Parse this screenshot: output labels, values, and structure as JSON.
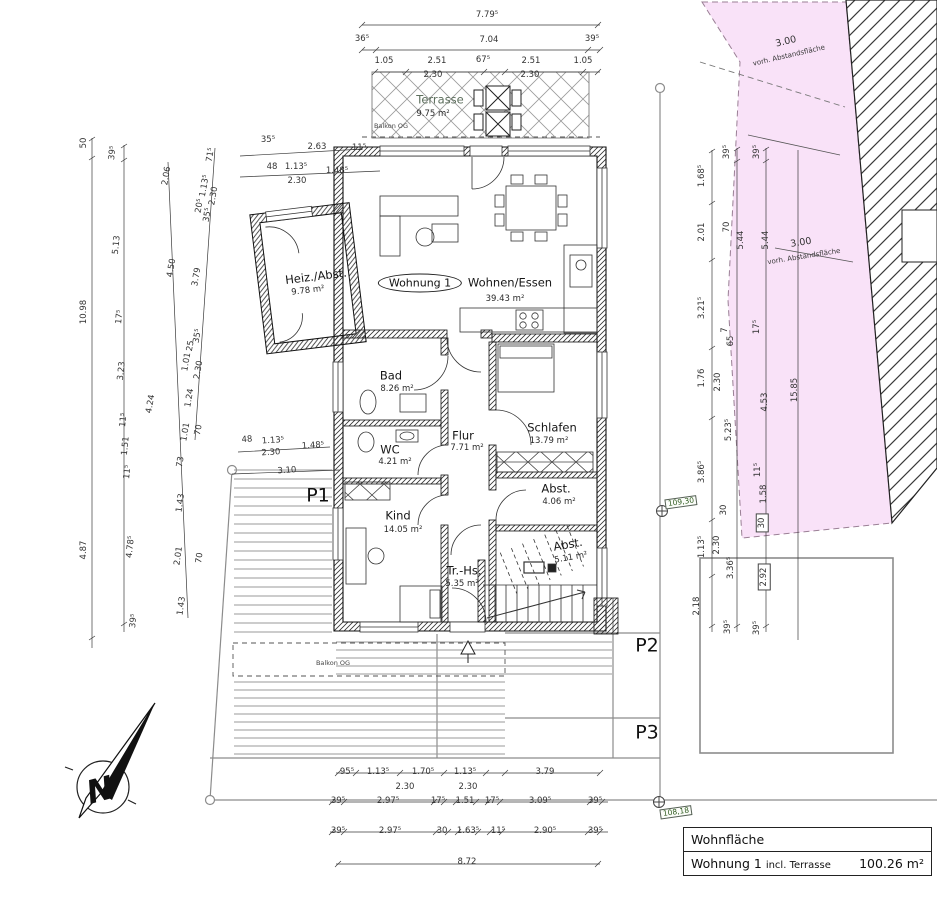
{
  "unit_tag": {
    "label": "Wohnung 1"
  },
  "north": {
    "label": "N"
  },
  "area_table": {
    "header": "Wohnfläche",
    "row": {
      "name": "Wohnung 1",
      "suffix": "incl. Terrasse",
      "value": "100.26 m²"
    }
  },
  "rooms": [
    {
      "name": "Terrasse",
      "area": "9.75 m²",
      "x": 440,
      "y": 100,
      "ax": 433,
      "ay": 114,
      "r": 0,
      "muted": true
    },
    {
      "name": "Wohnen/Essen",
      "area": "39.43 m²",
      "x": 510,
      "y": 283,
      "ax": 505,
      "ay": 299,
      "r": 0
    },
    {
      "name": "Heiz./Abst.",
      "area": "9.78 m²",
      "x": 316,
      "y": 277,
      "ax": 308,
      "ay": 291,
      "r": -7
    },
    {
      "name": "Bad",
      "area": "8.26 m²",
      "x": 391,
      "y": 376,
      "ax": 397,
      "ay": 389,
      "r": 0
    },
    {
      "name": "WC",
      "area": "4.21 m²",
      "x": 390,
      "y": 450,
      "ax": 395,
      "ay": 462,
      "r": 0
    },
    {
      "name": "Flur",
      "area": "7.71 m²",
      "x": 463,
      "y": 436,
      "ax": 467,
      "ay": 448,
      "r": 0
    },
    {
      "name": "Schlafen",
      "area": "13.79 m²",
      "x": 552,
      "y": 428,
      "ax": 549,
      "ay": 441,
      "r": 0
    },
    {
      "name": "Abst.",
      "area": "4.06 m²",
      "x": 556,
      "y": 489,
      "ax": 559,
      "ay": 502,
      "r": 0
    },
    {
      "name": "Kind",
      "area": "14.05 m²",
      "x": 398,
      "y": 516,
      "ax": 403,
      "ay": 530,
      "r": 0
    },
    {
      "name": "Tr.-Hs.",
      "area": "5.35 m²",
      "x": 464,
      "y": 571,
      "ax": 462,
      "ay": 584,
      "r": 0
    },
    {
      "name": "Abst.",
      "area": "5.11 m²",
      "x": 568,
      "y": 545,
      "ax": 571,
      "ay": 558,
      "r": -10
    }
  ],
  "parking_labels": [
    {
      "t": "P1",
      "x": 318,
      "y": 496
    },
    {
      "t": "P2",
      "x": 647,
      "y": 646
    },
    {
      "t": "P3",
      "x": 647,
      "y": 733
    }
  ],
  "balkon_labels": [
    {
      "t": "Balkon OG",
      "x": 391,
      "y": 126
    },
    {
      "t": "Balkon OG",
      "x": 333,
      "y": 663
    }
  ],
  "abstand_labels": [
    {
      "dim": "3.00",
      "text": "vorh. Abstandsfläche",
      "x": 786,
      "y": 42,
      "r": -13
    },
    {
      "dim": "3.00",
      "text": "vorh. Abstandsfläche",
      "x": 801,
      "y": 243,
      "r": -9
    }
  ],
  "survey_markers": [
    {
      "value": "109,30",
      "x": 681,
      "y": 502,
      "r": -8
    },
    {
      "value": "108,18",
      "x": 676,
      "y": 812,
      "r": -8
    }
  ],
  "dimension_labels": [
    {
      "t": "7.79⁵",
      "x": 487,
      "y": 15,
      "r": 0
    },
    {
      "t": "36⁵",
      "x": 362,
      "y": 39,
      "r": 0
    },
    {
      "t": "7.04",
      "x": 489,
      "y": 40,
      "r": 0
    },
    {
      "t": "39⁵",
      "x": 592,
      "y": 39,
      "r": 0
    },
    {
      "t": "1.05",
      "x": 384,
      "y": 61,
      "r": 0
    },
    {
      "t": "2.51",
      "x": 437,
      "y": 61,
      "r": 0
    },
    {
      "t": "67⁵",
      "x": 483,
      "y": 60,
      "r": 0
    },
    {
      "t": "2.51",
      "x": 531,
      "y": 61,
      "r": 0
    },
    {
      "t": "1.05",
      "x": 583,
      "y": 61,
      "r": 0
    },
    {
      "t": "2.30",
      "x": 433,
      "y": 75,
      "r": 0
    },
    {
      "t": "2.30",
      "x": 530,
      "y": 75,
      "r": 0
    },
    {
      "t": "35⁵",
      "x": 268,
      "y": 140,
      "r": 0
    },
    {
      "t": "2.63",
      "x": 317,
      "y": 147,
      "r": 0
    },
    {
      "t": "11⁵",
      "x": 359,
      "y": 148,
      "r": 0
    },
    {
      "t": "48",
      "x": 272,
      "y": 167,
      "r": 0
    },
    {
      "t": "1.13⁵",
      "x": 296,
      "y": 167,
      "r": 0
    },
    {
      "t": "1.48⁵",
      "x": 337,
      "y": 171,
      "r": 0
    },
    {
      "t": "2.30",
      "x": 297,
      "y": 181,
      "r": 0
    },
    {
      "t": "48",
      "x": 247,
      "y": 440,
      "r": -4
    },
    {
      "t": "1.13⁵",
      "x": 273,
      "y": 441,
      "r": -4
    },
    {
      "t": "1.48⁵",
      "x": 313,
      "y": 446,
      "r": -4
    },
    {
      "t": "2.30",
      "x": 271,
      "y": 453,
      "r": -4
    },
    {
      "t": "3.10",
      "x": 287,
      "y": 471,
      "r": -4
    },
    {
      "t": "50",
      "x": 84,
      "y": 143,
      "r": -90
    },
    {
      "t": "10.98",
      "x": 84,
      "y": 312,
      "r": -90
    },
    {
      "t": "4.87",
      "x": 84,
      "y": 550,
      "r": -90
    },
    {
      "t": "39⁵",
      "x": 113,
      "y": 153,
      "r": -84
    },
    {
      "t": "5.13",
      "x": 117,
      "y": 245,
      "r": -84
    },
    {
      "t": "17⁵",
      "x": 120,
      "y": 317,
      "r": -84
    },
    {
      "t": "3.23",
      "x": 122,
      "y": 371,
      "r": -84
    },
    {
      "t": "11⁵",
      "x": 124,
      "y": 420,
      "r": -84
    },
    {
      "t": "1.51",
      "x": 126,
      "y": 446,
      "r": -84
    },
    {
      "t": "11⁵",
      "x": 128,
      "y": 472,
      "r": -84
    },
    {
      "t": "4.78⁵",
      "x": 131,
      "y": 547,
      "r": -84
    },
    {
      "t": "39⁵",
      "x": 134,
      "y": 621,
      "r": -84
    },
    {
      "t": "2.06",
      "x": 167,
      "y": 176,
      "r": -80
    },
    {
      "t": "4.50",
      "x": 172,
      "y": 268,
      "r": -80
    },
    {
      "t": "4.24",
      "x": 151,
      "y": 404,
      "r": -80
    },
    {
      "t": "73",
      "x": 181,
      "y": 462,
      "r": -80
    },
    {
      "t": "1.43",
      "x": 181,
      "y": 503,
      "r": -82
    },
    {
      "t": "2.01",
      "x": 179,
      "y": 556,
      "r": -82
    },
    {
      "t": "1.43",
      "x": 182,
      "y": 606,
      "r": -82
    },
    {
      "t": "71⁵",
      "x": 211,
      "y": 155,
      "r": -80
    },
    {
      "t": "1.13⁵",
      "x": 205,
      "y": 186,
      "r": -80
    },
    {
      "t": "2.30",
      "x": 214,
      "y": 196,
      "r": -80
    },
    {
      "t": "20⁵",
      "x": 200,
      "y": 206,
      "r": -80
    },
    {
      "t": "35⁵",
      "x": 208,
      "y": 215,
      "r": -80
    },
    {
      "t": "3.79",
      "x": 197,
      "y": 277,
      "r": -80
    },
    {
      "t": "35⁵",
      "x": 198,
      "y": 336,
      "r": -80
    },
    {
      "t": "25",
      "x": 191,
      "y": 346,
      "r": -80
    },
    {
      "t": "1.01",
      "x": 187,
      "y": 362,
      "r": -80
    },
    {
      "t": "2.30",
      "x": 199,
      "y": 370,
      "r": -80
    },
    {
      "t": "1.24",
      "x": 190,
      "y": 398,
      "r": -80
    },
    {
      "t": "1.01",
      "x": 186,
      "y": 432,
      "r": -80
    },
    {
      "t": "70",
      "x": 199,
      "y": 430,
      "r": -80
    },
    {
      "t": "70",
      "x": 200,
      "y": 558,
      "r": -82
    },
    {
      "t": "1.68⁵",
      "x": 702,
      "y": 176,
      "r": -90
    },
    {
      "t": "2.01",
      "x": 702,
      "y": 232,
      "r": -90
    },
    {
      "t": "3.21⁵",
      "x": 702,
      "y": 308,
      "r": -90
    },
    {
      "t": "1.76",
      "x": 702,
      "y": 378,
      "r": -90
    },
    {
      "t": "3.86⁵",
      "x": 702,
      "y": 472,
      "r": -90
    },
    {
      "t": "1.13⁵",
      "x": 702,
      "y": 547,
      "r": -90
    },
    {
      "t": "2.18",
      "x": 697,
      "y": 606,
      "r": -90
    },
    {
      "t": "39⁵",
      "x": 727,
      "y": 152,
      "r": -90
    },
    {
      "t": "70",
      "x": 727,
      "y": 227,
      "r": -90
    },
    {
      "t": "7",
      "x": 725,
      "y": 330,
      "r": -90
    },
    {
      "t": "65",
      "x": 731,
      "y": 341,
      "r": -90
    },
    {
      "t": "2.30",
      "x": 718,
      "y": 382,
      "r": -90
    },
    {
      "t": "5.23⁵",
      "x": 729,
      "y": 430,
      "r": -90
    },
    {
      "t": "30",
      "x": 724,
      "y": 510,
      "r": -90
    },
    {
      "t": "2.30",
      "x": 717,
      "y": 545,
      "r": -90
    },
    {
      "t": "3.36⁵",
      "x": 731,
      "y": 568,
      "r": -90
    },
    {
      "t": "39⁵",
      "x": 728,
      "y": 627,
      "r": -90
    },
    {
      "t": "39⁵",
      "x": 757,
      "y": 152,
      "r": -90
    },
    {
      "t": "5.44",
      "x": 741,
      "y": 240,
      "r": -90
    },
    {
      "t": "5.44",
      "x": 766,
      "y": 240,
      "r": -90
    },
    {
      "t": "17⁵",
      "x": 757,
      "y": 327,
      "r": -90
    },
    {
      "t": "4.53",
      "x": 765,
      "y": 402,
      "r": -90
    },
    {
      "t": "11⁵",
      "x": 758,
      "y": 470,
      "r": -90
    },
    {
      "t": "1.58",
      "x": 764,
      "y": 494,
      "r": -90
    },
    {
      "t": "30",
      "x": 762,
      "y": 523,
      "r": -90,
      "box": true
    },
    {
      "t": "2.92",
      "x": 764,
      "y": 577,
      "r": -90,
      "box": true
    },
    {
      "t": "39⁵",
      "x": 757,
      "y": 628,
      "r": -90
    },
    {
      "t": "15.85",
      "x": 795,
      "y": 390,
      "r": -90
    },
    {
      "t": "95⁵",
      "x": 347,
      "y": 772,
      "r": 0
    },
    {
      "t": "1.13⁵",
      "x": 378,
      "y": 772,
      "r": 0
    },
    {
      "t": "1.70⁵",
      "x": 423,
      "y": 772,
      "r": 0
    },
    {
      "t": "1.13⁵",
      "x": 465,
      "y": 772,
      "r": 0
    },
    {
      "t": "3.79",
      "x": 545,
      "y": 772,
      "r": 0
    },
    {
      "t": "2.30",
      "x": 405,
      "y": 787,
      "r": 0
    },
    {
      "t": "2.30",
      "x": 468,
      "y": 787,
      "r": 0
    },
    {
      "t": "39⁵",
      "x": 338,
      "y": 801,
      "r": 0
    },
    {
      "t": "2.97⁵",
      "x": 388,
      "y": 801,
      "r": 0
    },
    {
      "t": "17⁵",
      "x": 438,
      "y": 801,
      "r": 0
    },
    {
      "t": "1.51",
      "x": 465,
      "y": 801,
      "r": 0
    },
    {
      "t": "17⁵",
      "x": 492,
      "y": 801,
      "r": 0
    },
    {
      "t": "3.09⁵",
      "x": 540,
      "y": 801,
      "r": 0
    },
    {
      "t": "39⁵",
      "x": 595,
      "y": 801,
      "r": 0
    },
    {
      "t": "39⁵",
      "x": 338,
      "y": 831,
      "r": 0
    },
    {
      "t": "2.97⁵",
      "x": 390,
      "y": 831,
      "r": 0
    },
    {
      "t": "30",
      "x": 442,
      "y": 831,
      "r": 0
    },
    {
      "t": "1.63⁵",
      "x": 468,
      "y": 831,
      "r": 0
    },
    {
      "t": "11⁵",
      "x": 498,
      "y": 831,
      "r": 0
    },
    {
      "t": "2.90⁵",
      "x": 545,
      "y": 831,
      "r": 0
    },
    {
      "t": "39⁵",
      "x": 595,
      "y": 831,
      "r": 0
    },
    {
      "t": "8.72",
      "x": 467,
      "y": 862,
      "r": 0
    }
  ]
}
